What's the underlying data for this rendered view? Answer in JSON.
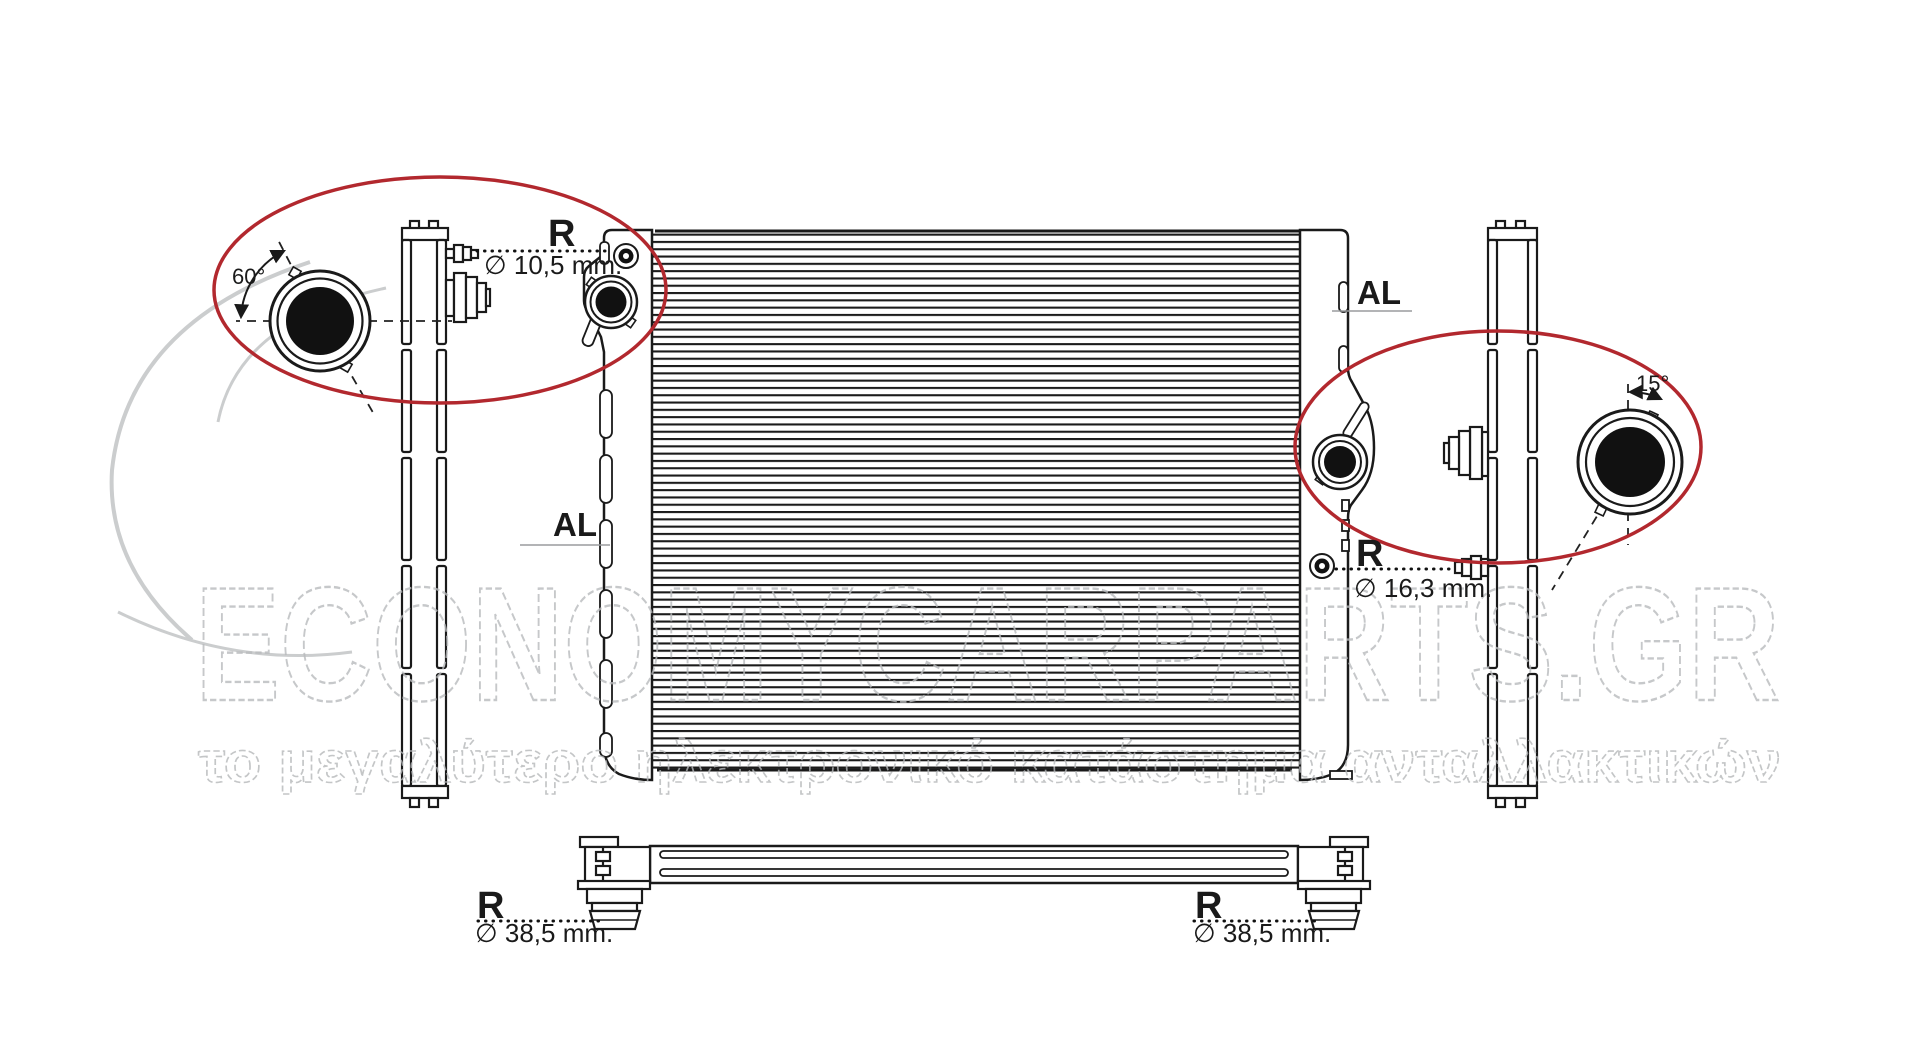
{
  "colors": {
    "line": "#1a1a1a",
    "highlight_red": "#b2282e",
    "watermark_gray": "#b9bbbd",
    "swoosh_gray": "#cbcdce"
  },
  "annotations": {
    "angle_left": "60°",
    "angle_right": "15°",
    "material_left": "AL",
    "material_right": "AL",
    "ref_top_left": {
      "label": "R",
      "diameter": "∅ 10,5 mm."
    },
    "ref_mid_right": {
      "label": "R",
      "diameter": "∅ 16,3 mm."
    },
    "ref_bottom_left": {
      "label": "R",
      "diameter": "∅ 38,5 mm."
    },
    "ref_bottom_right": {
      "label": "R",
      "diameter": "∅ 38,5 mm."
    }
  },
  "watermark": {
    "brand": "ECONOMYCARPARTS.GR",
    "tagline": "το μεγαλύτερο ηλεκτρονικό κατάστημα ανταλλακτικών"
  }
}
